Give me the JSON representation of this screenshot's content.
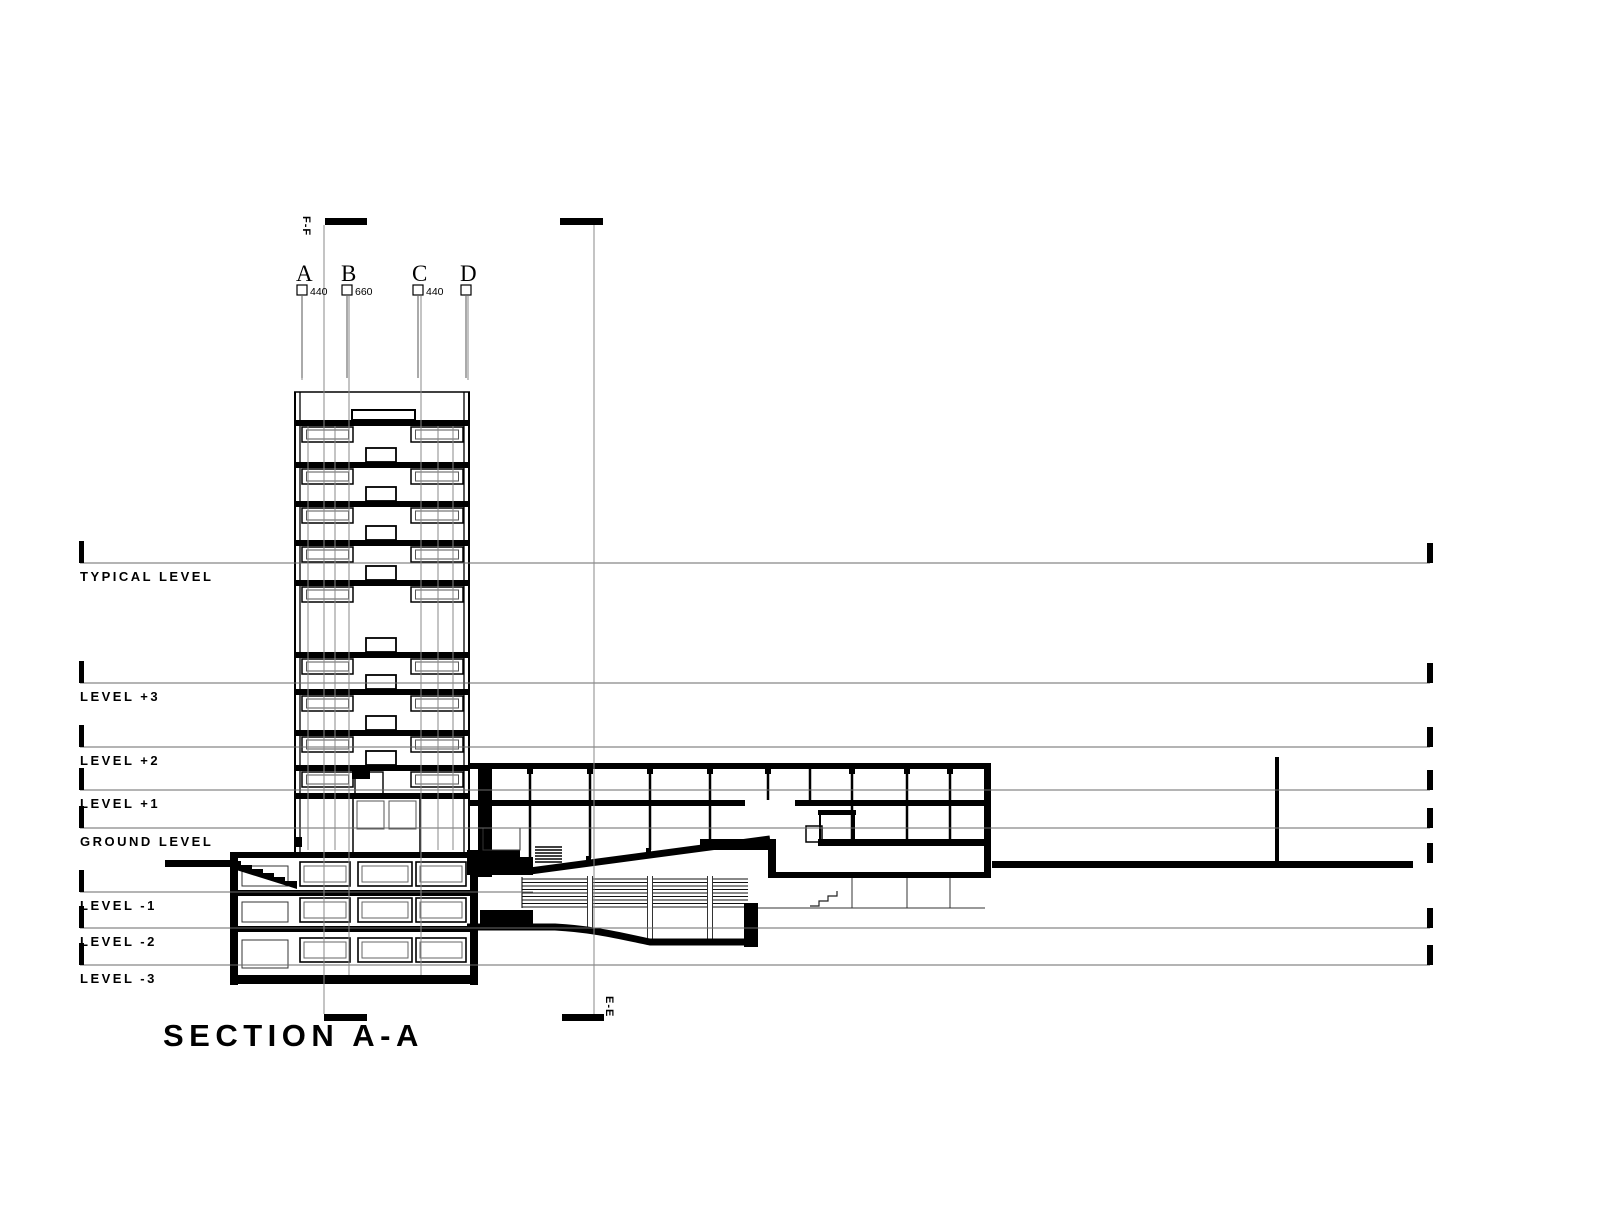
{
  "drawing": {
    "title": "SECTION A-A",
    "levels": [
      {
        "label": "TYPICAL LEVEL"
      },
      {
        "label": "LEVEL +3"
      },
      {
        "label": "LEVEL +2"
      },
      {
        "label": "LEVEL +1"
      },
      {
        "label": "GROUND LEVEL"
      },
      {
        "label": "LEVEL -1"
      },
      {
        "label": "LEVEL -2"
      },
      {
        "label": "LEVEL -3"
      }
    ],
    "grid_columns": [
      {
        "letter": "A",
        "dimension": "440"
      },
      {
        "letter": "B",
        "dimension": "660"
      },
      {
        "letter": "C",
        "dimension": "440"
      },
      {
        "letter": "D",
        "dimension": ""
      }
    ],
    "section_markers": {
      "top_left": "F-F",
      "bottom_right": "E-E"
    },
    "colors": {
      "ink": "#000000",
      "reference_line": "#6a6a6a"
    }
  }
}
